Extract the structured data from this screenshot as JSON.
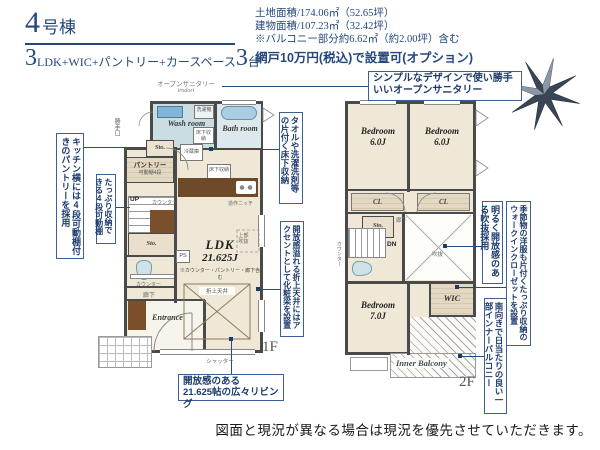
{
  "header": {
    "building_num": "4",
    "building_suffix": "号棟",
    "plan_num1": "3",
    "plan_body": "LDK+WIC+パントリー+カースペース",
    "plan_num2": "3",
    "plan_tail": "台",
    "land_area": "土地面積/174.06㎡（52.65坪）",
    "building_area": "建物面積/107.23㎡（32.42坪）",
    "balcony_note": "※バルコニー部分約6.62㎡（約2.00坪）含む",
    "option_note": "網戸10万円(税込)で設置可(オプション)"
  },
  "callouts": {
    "sanitary_line1": "シンプルなデザインで使い勝手",
    "sanitary_line2": "いいオープンサニタリー",
    "pantry": "キッチン横には4段可動棚付きのパントリーを採用",
    "shelf": "たっぷり収納できる4段可動棚",
    "floor_storage": "タオルや洗濯洗剤等の片付く床下収納",
    "ceiling_beam": "開放感溢れる折上天井にはアクセントとして化粧梁を設置",
    "living_line1": "開放感のある",
    "living_line2": "21.625帖の広々リビング",
    "wic": "季節物の洋服も片付くたっぷり収納のウォークインクローゼットを設置",
    "void": "明るく開放感のある吹抜採用",
    "balcony": "南向きで日当たりの良い一部インナーバルコニー"
  },
  "floor1": {
    "floor_label": "1F",
    "sanitary_name": "オープンサニタリー",
    "sanitary_brand": "irodori",
    "wash_room": "Wash room",
    "washer": "洗濯機",
    "floor_storage_wash": "床下収納",
    "bath_room": "Bath room",
    "side_door": "勝手口",
    "storage1": "Sto.",
    "pantry_name": "パントリー",
    "pantry_shelf": "可動棚4段",
    "fridge": "冷蔵庫",
    "floor_storage_kitchen": "床下収納",
    "niche": "造作ニッチ",
    "up": "UP",
    "counter1": "カウンター",
    "storage2": "Sto.",
    "ps": "PS",
    "counter2": "カウンター",
    "hallway": "廊下",
    "entrance": "Entrance",
    "ldk_name": "LDK",
    "ldk_size": "21.625J",
    "ldk_note": "※カウンター・パントリー・廊下含む",
    "upper_void": "上部吹抜",
    "coffered_ceiling": "折上天井",
    "shutter": "シャッター"
  },
  "floor2": {
    "floor_label": "2F",
    "bedroom1_name": "Bedroom",
    "bedroom1_size": "6.0J",
    "bedroom2_name": "Bedroom",
    "bedroom2_size": "6.0J",
    "bedroom3_name": "Bedroom",
    "bedroom3_size": "7.0J",
    "cl1": "CL",
    "cl2": "CL",
    "storage": "Sto.",
    "hallway": "廊下",
    "dn": "DN",
    "counter": "カウンター",
    "void_label": "吹抜",
    "wic": "WIC",
    "balcony": "Inner Balcony"
  },
  "footer": {
    "disclaimer": "図面と現況が異なる場合は現況を優先させていただきます。"
  },
  "colors": {
    "navy": "#24487c",
    "wall": "#4a4a4a",
    "room_cream": "#efe8d6",
    "wet_blue": "#c9dde2",
    "bath_blue": "#dce8ec",
    "tub_blue": "#a9cee4",
    "wood_brown": "#6f4a28",
    "closet_tan": "#e3d8c2"
  }
}
